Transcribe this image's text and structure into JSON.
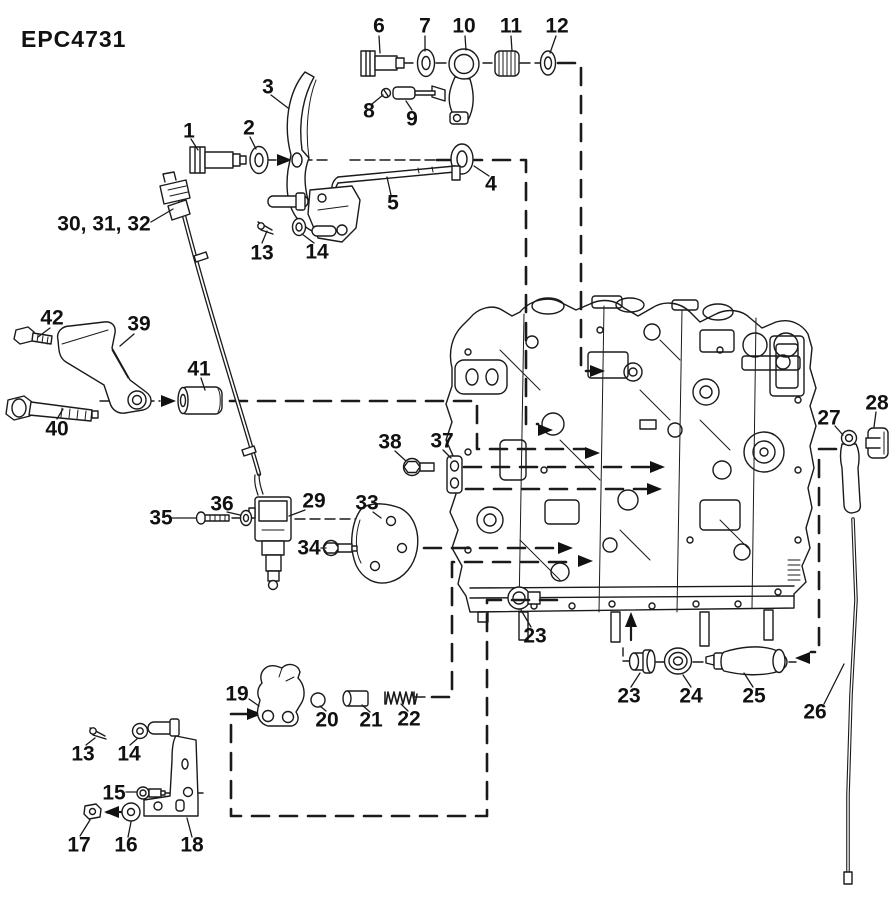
{
  "diagram": {
    "code": "EPC4731",
    "background_color": "#ffffff",
    "line_color": "#1a1a1a",
    "type": "exploded-parts-diagram"
  },
  "labels": [
    {
      "name": "1",
      "text": "1",
      "x": 189,
      "y": 131
    },
    {
      "name": "2",
      "text": "2",
      "x": 249,
      "y": 128
    },
    {
      "name": "3",
      "text": "3",
      "x": 268,
      "y": 87
    },
    {
      "name": "4",
      "text": "4",
      "x": 491,
      "y": 184
    },
    {
      "name": "5",
      "text": "5",
      "x": 393,
      "y": 203
    },
    {
      "name": "6",
      "text": "6",
      "x": 379,
      "y": 26
    },
    {
      "name": "7",
      "text": "7",
      "x": 425,
      "y": 26
    },
    {
      "name": "8",
      "text": "8",
      "x": 369,
      "y": 111
    },
    {
      "name": "9",
      "text": "9",
      "x": 412,
      "y": 119
    },
    {
      "name": "10",
      "text": "10",
      "x": 464,
      "y": 26
    },
    {
      "name": "11",
      "text": "11",
      "x": 511,
      "y": 26
    },
    {
      "name": "12",
      "text": "12",
      "x": 557,
      "y": 26
    },
    {
      "name": "13-top",
      "text": "13",
      "x": 262,
      "y": 253
    },
    {
      "name": "14-top",
      "text": "14",
      "x": 317,
      "y": 252
    },
    {
      "name": "30-31-32",
      "text": "30, 31, 32",
      "x": 104,
      "y": 224
    },
    {
      "name": "42",
      "text": "42",
      "x": 52,
      "y": 318
    },
    {
      "name": "39",
      "text": "39",
      "x": 139,
      "y": 324
    },
    {
      "name": "41",
      "text": "41",
      "x": 199,
      "y": 369
    },
    {
      "name": "40",
      "text": "40",
      "x": 57,
      "y": 429
    },
    {
      "name": "35",
      "text": "35",
      "x": 161,
      "y": 518
    },
    {
      "name": "36",
      "text": "36",
      "x": 222,
      "y": 504
    },
    {
      "name": "29",
      "text": "29",
      "x": 314,
      "y": 501
    },
    {
      "name": "33",
      "text": "33",
      "x": 367,
      "y": 503
    },
    {
      "name": "34",
      "text": "34",
      "x": 309,
      "y": 548
    },
    {
      "name": "38",
      "text": "38",
      "x": 390,
      "y": 442
    },
    {
      "name": "37",
      "text": "37",
      "x": 442,
      "y": 441
    },
    {
      "name": "23-engine",
      "text": "23",
      "x": 535,
      "y": 636
    },
    {
      "name": "23-lower",
      "text": "23",
      "x": 629,
      "y": 696
    },
    {
      "name": "24",
      "text": "24",
      "x": 691,
      "y": 696
    },
    {
      "name": "25",
      "text": "25",
      "x": 754,
      "y": 696
    },
    {
      "name": "26",
      "text": "26",
      "x": 815,
      "y": 712
    },
    {
      "name": "27",
      "text": "27",
      "x": 829,
      "y": 418
    },
    {
      "name": "28",
      "text": "28",
      "x": 877,
      "y": 403
    },
    {
      "name": "19",
      "text": "19",
      "x": 237,
      "y": 694
    },
    {
      "name": "20",
      "text": "20",
      "x": 327,
      "y": 720
    },
    {
      "name": "21",
      "text": "21",
      "x": 371,
      "y": 720
    },
    {
      "name": "22",
      "text": "22",
      "x": 409,
      "y": 719
    },
    {
      "name": "13-bottom",
      "text": "13",
      "x": 83,
      "y": 754
    },
    {
      "name": "14-bottom",
      "text": "14",
      "x": 129,
      "y": 754
    },
    {
      "name": "15",
      "text": "15",
      "x": 114,
      "y": 793
    },
    {
      "name": "17",
      "text": "17",
      "x": 79,
      "y": 845
    },
    {
      "name": "16",
      "text": "16",
      "x": 126,
      "y": 845
    },
    {
      "name": "18",
      "text": "18",
      "x": 192,
      "y": 845
    }
  ]
}
